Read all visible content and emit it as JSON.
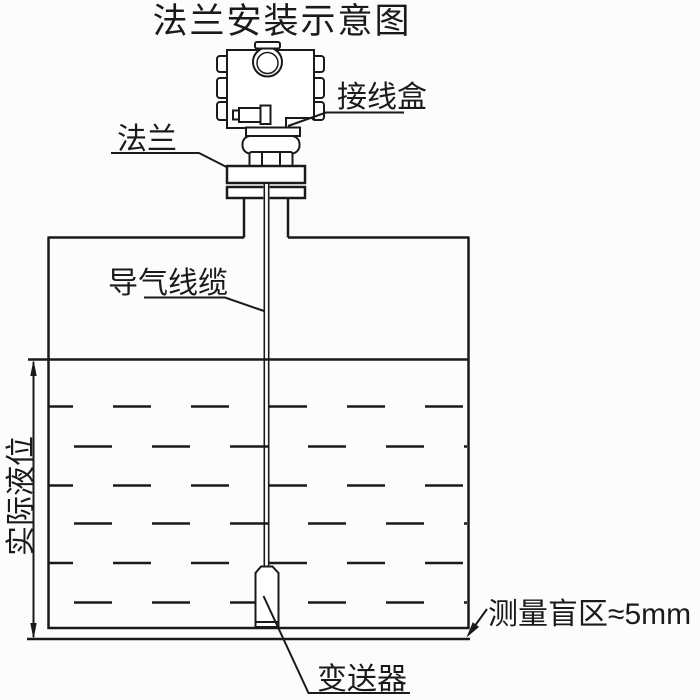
{
  "diagram": {
    "title": "法兰安装示意图",
    "labels": {
      "junction_box": "接线盒",
      "flange": "法兰",
      "air_guide_cable": "导气线缆",
      "actual_liquid_level": "实际液位",
      "measurement_blind_zone": "测量盲区≈5mm",
      "transmitter": "变送器"
    },
    "colors": {
      "ink": "#1a1a1a",
      "background": "#fcfcfc"
    }
  }
}
